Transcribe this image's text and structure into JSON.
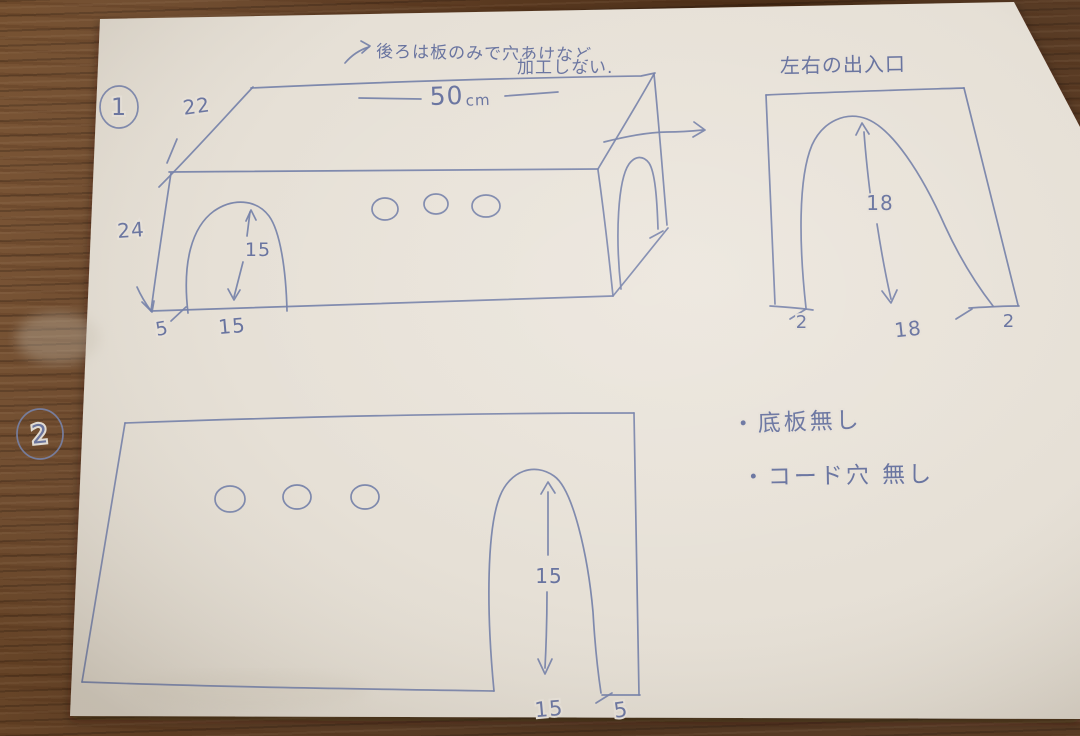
{
  "scene": {
    "description": "hand-drawn plan of a wooden pet-house box on paper, photographed on a wood table",
    "ink_color": "#7480a8",
    "paper_color": "#e7e1d8",
    "wood_color": "#5a3a22"
  },
  "drawing1": {
    "number": "1",
    "note_line1": "後ろは板のみで穴あけなど",
    "note_line2": "加工しない.",
    "dim_slant": "22",
    "dim_left_height": "24",
    "dim_top_length_value": "50",
    "dim_top_length_unit": "cm",
    "dim_arch_height": "15",
    "dim_arch_width": "15",
    "dim_side_margin": "5"
  },
  "side_opening": {
    "title": "左右の出入口",
    "dim_height": "18",
    "dim_width": "18",
    "dim_left_margin": "2",
    "dim_right_margin": "2"
  },
  "notes": {
    "item1": "・底板無し",
    "item2": "・コード穴 無し"
  },
  "drawing2": {
    "number": "2",
    "dim_arch_height": "15",
    "dim_arch_width": "15",
    "dim_side_margin": "5"
  }
}
